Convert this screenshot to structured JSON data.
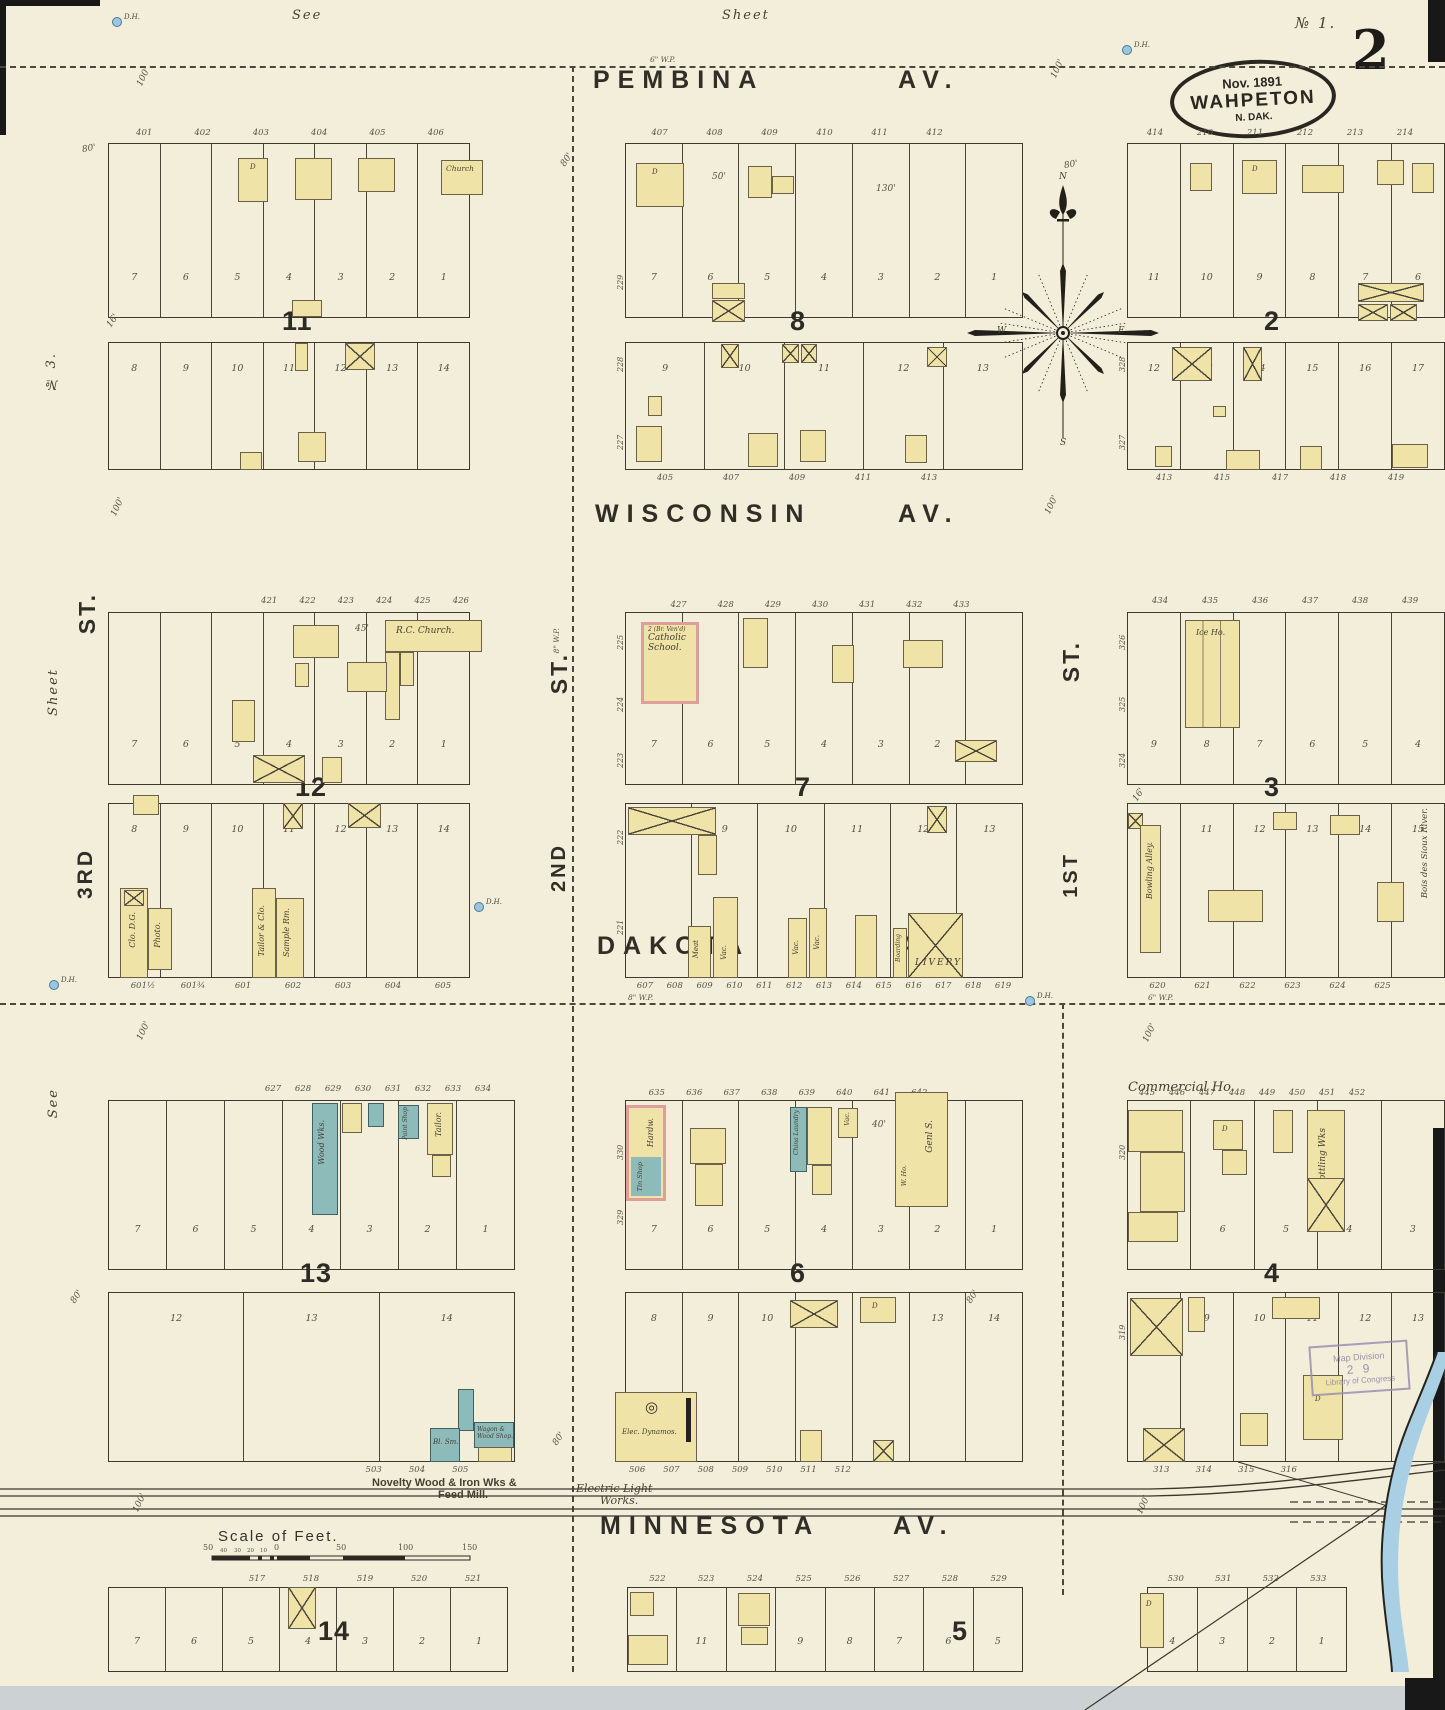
{
  "page": {
    "top_left_note": "See",
    "top_center_note": "Sheet",
    "top_right_note": "№ 1.",
    "sheet_number": "2",
    "stamp": {
      "date": "Nov. 1891",
      "city": "WAHPETON",
      "state": "N. DAK."
    },
    "left_margin": {
      "top_note": "№ 3.",
      "middle_note": "Sheet",
      "bottom_note": "See"
    },
    "loc_stamp": {
      "line1": "Map Division",
      "line2": "2 9",
      "line3": "Library of Congress"
    }
  },
  "streets": {
    "pembina": "PEMBINA",
    "wisconsin": "WISCONSIN",
    "dakota": "DAKOTA",
    "minnesota": "MINNESOTA",
    "avenue_abbr": "AV.",
    "third": "3RD",
    "second": "2ND",
    "first": "1ST",
    "street_abbr": "ST.",
    "river_label": "Bois des Sioux River."
  },
  "compass": {
    "north": "N",
    "south": "S",
    "east": "E",
    "west": "W"
  },
  "scale_bar": {
    "title": "Scale of Feet.",
    "major_ticks": [
      "50",
      "0",
      "50",
      "100",
      "150"
    ],
    "minor_ticks": [
      "40",
      "30",
      "20",
      "10"
    ]
  },
  "annotations": {
    "hydrant": "D.H.",
    "water_pipe_6": "6\" W.P.",
    "water_pipe_8": "8\" W.P.",
    "dim_80": "80'",
    "dim_100": "100'",
    "dim_16": "16'",
    "dim_40": "40'",
    "dim_50": "50'",
    "dim_130": "130'",
    "dim_45": "45'",
    "dwelling": "D",
    "vacant": "Vac."
  },
  "labels": {
    "church": "Church",
    "rc_church": "R.C. Church.",
    "school_note": "2 (Br. Ven'd)",
    "catholic_school_1": "Catholic",
    "catholic_school_2": "School.",
    "ice_house": "Ice Ho.",
    "livery": "LIVERY",
    "boarding": "Boarding",
    "meat": "Meat",
    "bowling_alley": "Bowling Alley.",
    "commercial_house": "Commercial Ho.",
    "bottling_works": "Bottling Wks",
    "general_store": "Genl S.",
    "warehouse": "W. Ho.",
    "china_laundry": "China Laundry",
    "hardware": "Hardw.",
    "tin_shop": "Tin Shop",
    "tailor": "Tailor.",
    "paint_shop": "Paint Shop",
    "wood_works": "Wood Wks.",
    "photo": "Photo.",
    "clothing_dry_goods": "Clo. D.G.",
    "tailor_clothing": "Tailor & Clo.",
    "sample_room": "Sample Rm.",
    "blacksmith": "Bl. Sm.",
    "wagon_shop_1": "Wagon &",
    "wagon_shop_2": "Wood Shop.",
    "electric_dynamos": "Elec. Dynamos.",
    "novelty_1": "Novelty Wood & Iron Wks &",
    "novelty_2": "Feed Mill.",
    "electric_light_1": "Electric Light",
    "electric_light_2": "Works."
  },
  "blocks": {
    "b11": {
      "number": "11",
      "top_numbers": [
        "401",
        "402",
        "403",
        "404",
        "405",
        "406"
      ],
      "upper_lots": [
        "7",
        "6",
        "5",
        "4",
        "3",
        "2",
        "1"
      ],
      "lower_lots": [
        "8",
        "9",
        "10",
        "11",
        "12",
        "13",
        "14"
      ]
    },
    "b8": {
      "number": "8",
      "top_numbers": [
        "407",
        "408",
        "409",
        "410",
        "411",
        "412"
      ],
      "upper_lots": [
        "7",
        "6",
        "5",
        "4",
        "3",
        "2",
        "1"
      ],
      "lower_lots": [
        "9",
        "10",
        "11",
        "12",
        "13"
      ],
      "bottom_numbers": [
        "405",
        "407",
        "409",
        "411",
        "413"
      ],
      "left_numbers": [
        "229",
        "228",
        "227"
      ]
    },
    "b2": {
      "number": "2",
      "top_numbers": [
        "414",
        "210",
        "211",
        "212",
        "213",
        "214"
      ],
      "upper_lots": [
        "11",
        "10",
        "9",
        "8",
        "7",
        "6"
      ],
      "lower_lots": [
        "12",
        "13",
        "14",
        "15",
        "16",
        "17"
      ],
      "bottom_numbers": [
        "413",
        "415",
        "417",
        "418",
        "419"
      ],
      "left_numbers": [
        "328",
        "327"
      ]
    },
    "b12": {
      "number": "12",
      "top_numbers": [
        "421",
        "422",
        "423",
        "424",
        "425",
        "426"
      ],
      "upper_lots": [
        "7",
        "6",
        "5",
        "4",
        "3",
        "2",
        "1"
      ],
      "lower_lots": [
        "8",
        "9",
        "10",
        "11",
        "12",
        "13",
        "14"
      ],
      "bottom_numbers": [
        "601½",
        "601¾",
        "601",
        "602",
        "603",
        "604",
        "605"
      ]
    },
    "b7": {
      "number": "7",
      "top_numbers": [
        "427",
        "428",
        "429",
        "430",
        "431",
        "432",
        "433"
      ],
      "upper_lots": [
        "7",
        "6",
        "5",
        "4",
        "3",
        "2",
        "1"
      ],
      "lower_lots": [
        "8",
        "9",
        "10",
        "11",
        "12",
        "13"
      ],
      "bottom_numbers": [
        "607",
        "608",
        "609",
        "610",
        "611",
        "612",
        "613",
        "614",
        "615",
        "616",
        "617",
        "618",
        "619"
      ],
      "left_numbers": [
        "225",
        "224",
        "223",
        "222",
        "221"
      ]
    },
    "b3": {
      "number": "3",
      "top_numbers": [
        "434",
        "435",
        "436",
        "437",
        "438",
        "439"
      ],
      "upper_lots": [
        "9",
        "8",
        "7",
        "6",
        "5",
        "4"
      ],
      "lower_lots": [
        "10",
        "11",
        "12",
        "13",
        "14",
        "15"
      ],
      "bottom_numbers": [
        "620",
        "621",
        "622",
        "623",
        "624",
        "625"
      ],
      "left_numbers": [
        "326",
        "325",
        "324"
      ]
    },
    "b13": {
      "number": "13",
      "top_numbers": [
        "627",
        "628",
        "629",
        "630",
        "631",
        "632",
        "633",
        "634"
      ],
      "upper_lots": [
        "7",
        "6",
        "5",
        "4",
        "3",
        "2",
        "1"
      ],
      "lower_lots": [
        "12",
        "13",
        "14"
      ],
      "bottom_numbers": [
        "503",
        "504",
        "505"
      ]
    },
    "b6": {
      "number": "6",
      "top_numbers": [
        "635",
        "636",
        "637",
        "638",
        "639",
        "640",
        "641",
        "642"
      ],
      "upper_lots": [
        "7",
        "6",
        "5",
        "4",
        "3",
        "2",
        "1"
      ],
      "lower_lots": [
        "8",
        "9",
        "10",
        "11",
        "12",
        "13",
        "14"
      ],
      "bottom_numbers": [
        "506",
        "507",
        "508",
        "509",
        "510",
        "511",
        "512"
      ],
      "left_numbers": [
        "330",
        "329"
      ]
    },
    "b4": {
      "number": "4",
      "top_numbers": [
        "445",
        "446",
        "447",
        "448",
        "449",
        "450",
        "451",
        "452"
      ],
      "upper_lots": [
        "7",
        "6",
        "5",
        "4",
        "3"
      ],
      "lower_lots": [
        "8",
        "9",
        "10",
        "11",
        "12",
        "13"
      ],
      "bottom_numbers": [
        "313",
        "314",
        "315",
        "316"
      ],
      "left_numbers": [
        "320",
        "319"
      ]
    },
    "b14": {
      "number": "14",
      "top_numbers": [
        "517",
        "518",
        "519",
        "520",
        "521"
      ],
      "lots": [
        "7",
        "6",
        "5",
        "4",
        "3",
        "2",
        "1"
      ]
    },
    "b5": {
      "number": "5",
      "top_numbers": [
        "522",
        "523",
        "524",
        "525",
        "526",
        "527",
        "528",
        "529"
      ],
      "lots": [
        "12",
        "11",
        "10",
        "9",
        "8",
        "7",
        "6",
        "5"
      ]
    },
    "b5e": {
      "top_numbers": [
        "530",
        "531",
        "532",
        "533"
      ],
      "lots": [
        "4",
        "3",
        "2",
        "1"
      ]
    }
  }
}
